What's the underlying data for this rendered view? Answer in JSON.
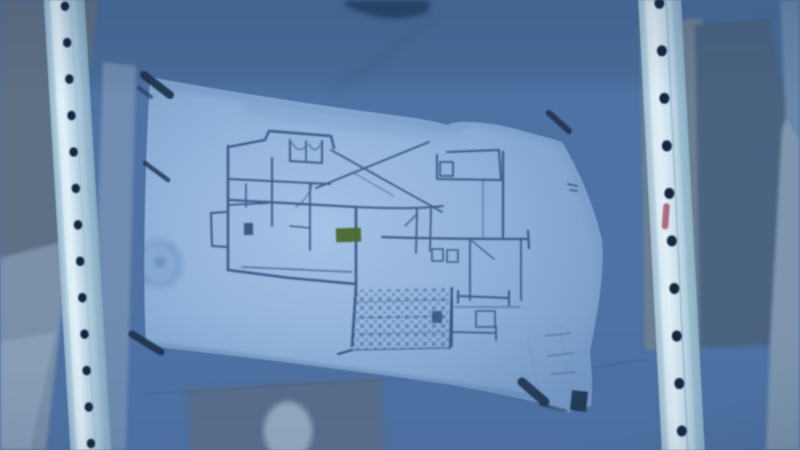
{
  "colors": {
    "wall_base": "#4f72a2",
    "wall_top": "#4a6b94",
    "wall_topleft_gray": "#5f7083",
    "wall_left_light": "#7b90a8",
    "wall_bottomleft_light": "#8ca2b8",
    "wall_seam_light": "#7e97b4",
    "wall_right_gray": "#6d7f91",
    "wall_right_dark_panel": "#4c6480",
    "wall_right_edge_top": "#6888a8",
    "wall_right_edge_bottom": "#7e95ad",
    "below_paper_shadow": "#5a6e88",
    "below_paper_blob": "#96abc1",
    "ceiling_blob": "#2c4566",
    "seam_line": "#466180",
    "paper": "#8fb0d6",
    "paper_highlight": "#a7c3e5",
    "paper_shadow": "#7598c4",
    "paper_edge_shadow": "#5e82ae",
    "ink": "#31507f",
    "ink_dark": "#24406b",
    "highlight_green": "#4d6a33",
    "tape_dark": "#1c3048",
    "stain": "#7fa3cc",
    "stain_core": "#6a90bc",
    "stud_body": "#b9d2e2",
    "stud_body_bright": "#c6dbe8",
    "stud_highlight": "#e2f1f8",
    "stud_shadow": "#8fb3c9",
    "stud_hole": "#132742",
    "red_mark": "#a3556b"
  },
  "studs": {
    "left": {
      "hole_count": 13
    },
    "right": {
      "hole_count": 10
    }
  }
}
